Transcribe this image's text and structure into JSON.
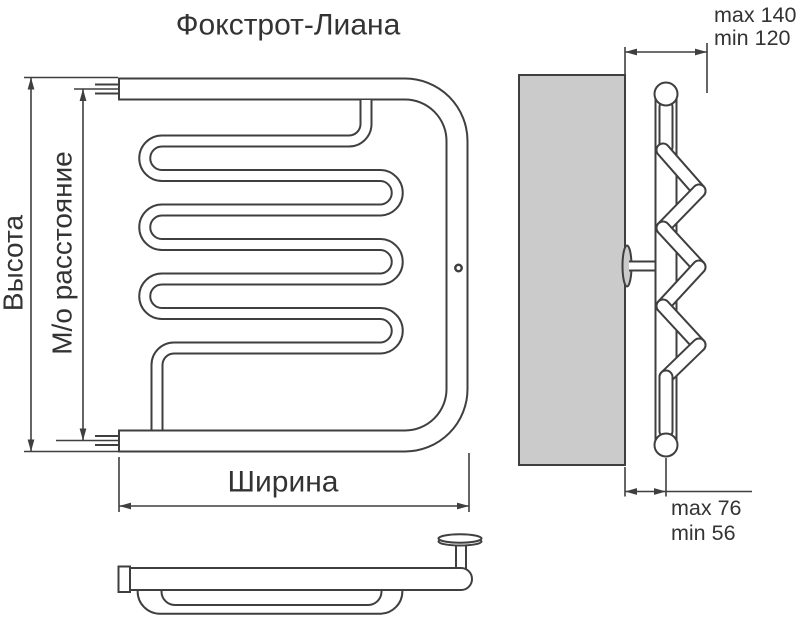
{
  "title": "Фокстрот-Лиана",
  "front_view": {
    "height_label": "Высота",
    "axial_distance_label": "М/о расстояние",
    "width_label": "Ширина"
  },
  "side_view": {
    "wall_offset_max": "max 140",
    "wall_offset_min": "min 120",
    "mount_depth_max": "max 76",
    "mount_depth_min": "min 56"
  },
  "colors": {
    "line": "#3f3f3f",
    "wall_fill": "#cbcbcb",
    "text": "#333333"
  }
}
